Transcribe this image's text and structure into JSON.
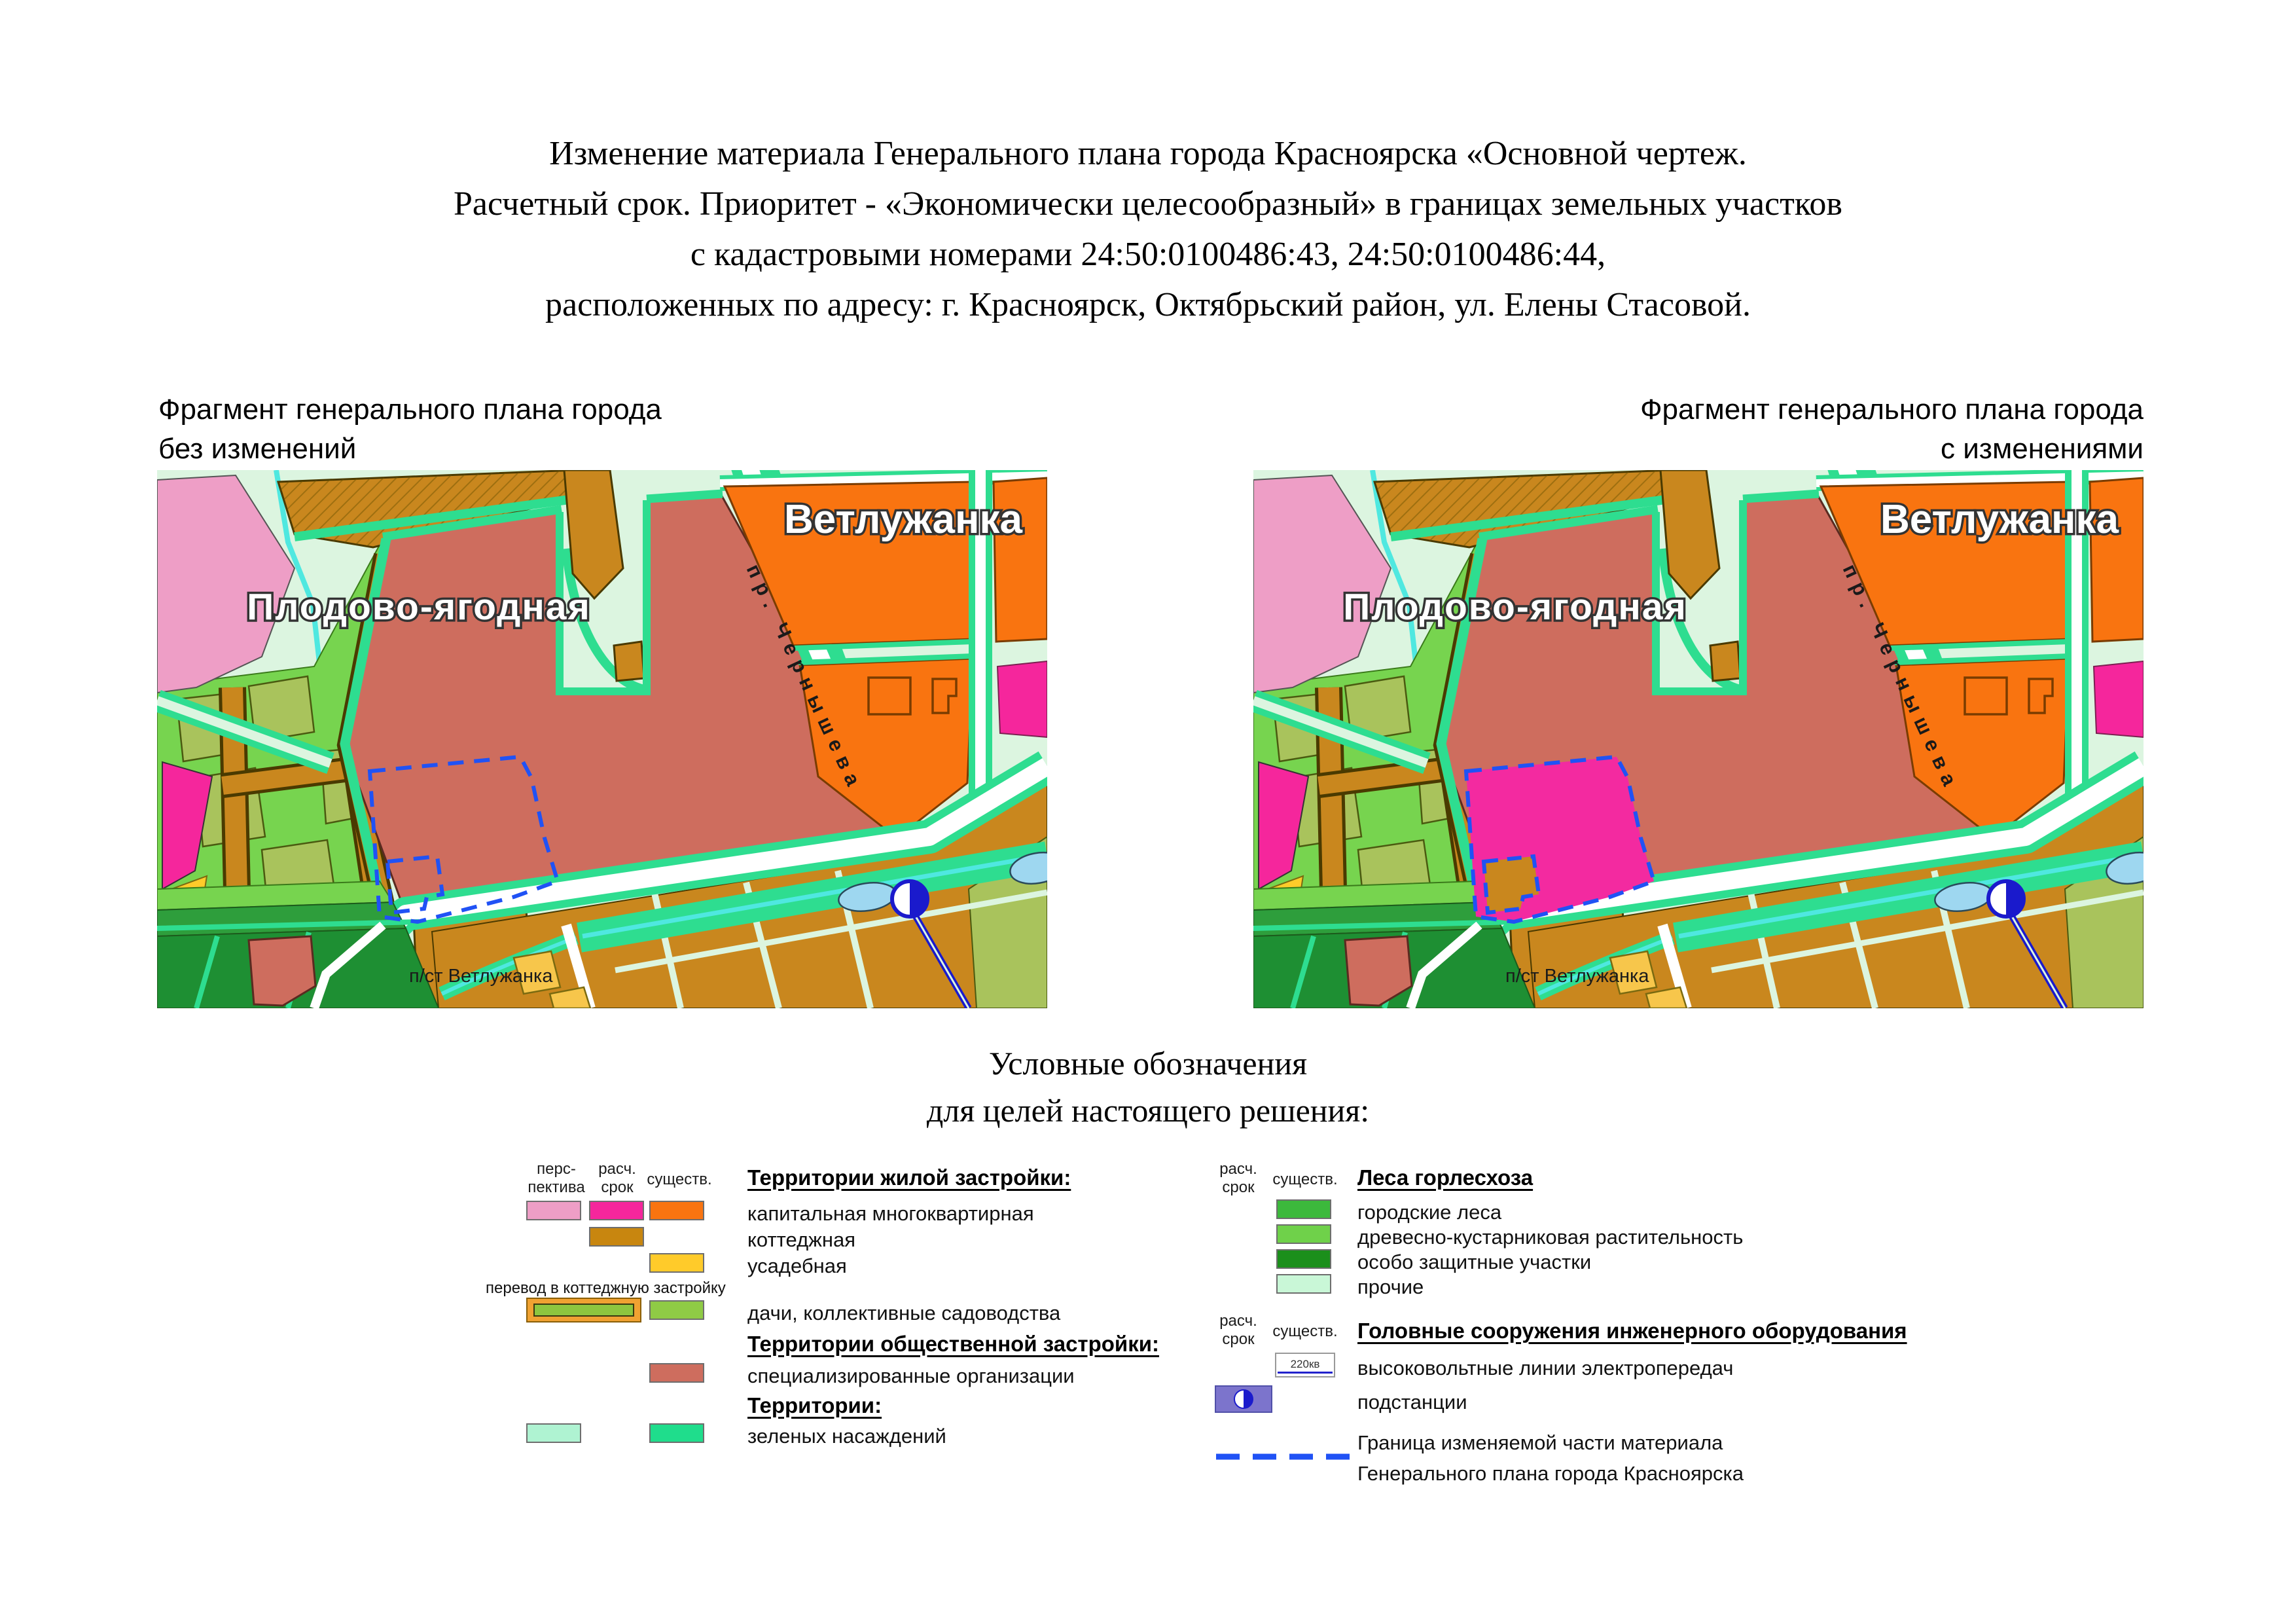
{
  "title": {
    "line1": "Изменение материала Генерального плана города Красноярска «Основной чертеж.",
    "line2": "Расчетный срок. Приоритет  - «Экономически целесообразный» в границах земельных участков",
    "line3": "с кадастровыми номерами 24:50:0100486:43, 24:50:0100486:44,",
    "line4": "расположенных по адресу: г. Красноярск, Октябрьский район, ул. Елены Стасовой."
  },
  "captions": {
    "left": {
      "line1": "Фрагмент генерального плана города",
      "line2": "без изменений"
    },
    "right": {
      "line1": "Фрагмент генерального плана города",
      "line2": "с изменениями"
    }
  },
  "map_labels": {
    "district": "Плодово-ягодная",
    "neighborhood": "Ветлужанка",
    "street": "пр. Чернышева",
    "substation": "п/ст Ветлужанка"
  },
  "legend": {
    "heading_line1": "Условные обозначения",
    "heading_line2": "для целей настоящего решения:",
    "columns": {
      "perspective_1": "перс-",
      "perspective_2": "пектива",
      "rasch_1": "расч.",
      "rasch_2": "срок",
      "existing": "существ."
    },
    "left": {
      "section1_title": "Территории жилой застройки:",
      "item_capital": "капитальная многоквартирная",
      "item_cottage": "коттеджная",
      "item_usadeb": "усадебная",
      "perevod_note": "перевод в коттеджную застройку",
      "item_dachi": "дачи, коллективные садоводства",
      "section2_title": "Территории общественной застройки:",
      "item_spec": "специализированные организации",
      "section3_title": "Территории:",
      "item_green": " зеленых насаждений"
    },
    "right": {
      "section1_title": "Леса горлесхоза",
      "item_city_forest": "городские леса",
      "item_shrub": "древесно-кустарниковая растительность",
      "item_protected": "особо защитные участки",
      "item_other": "прочие",
      "section2_title": "Головные сооружения инженерного оборудования",
      "item_power_lines": "высоковольтные линии электропередач",
      "power_line_label": "220кв",
      "item_substation": "подстанции",
      "border_line1": "Граница изменяемой части материала",
      "border_line2": "Генерального плана города Красноярска"
    }
  },
  "colors": {
    "perspective_pink": "#EE9EC6",
    "rasch_magenta": "#F5269C",
    "existing_orange": "#F97410",
    "cottage_brown": "#C8860F",
    "usadeb_yellow": "#FFCB2A",
    "dachi_green": "#8FCB45",
    "spec_salmon": "#CE6D5E",
    "territory_mint": "#AFF3D2",
    "green_spaces": "#1FDD8C",
    "city_forest": "#3CB93C",
    "shrub_green": "#6FD14A",
    "protected_green": "#1B8F1B",
    "other_mint": "#C9F7D7",
    "substation_violet": "#7C74CC",
    "substation_blue": "#1A1ACC",
    "boundary_dash_blue": "#2052F5",
    "changed_fill_magenta": "#F32AA0"
  }
}
